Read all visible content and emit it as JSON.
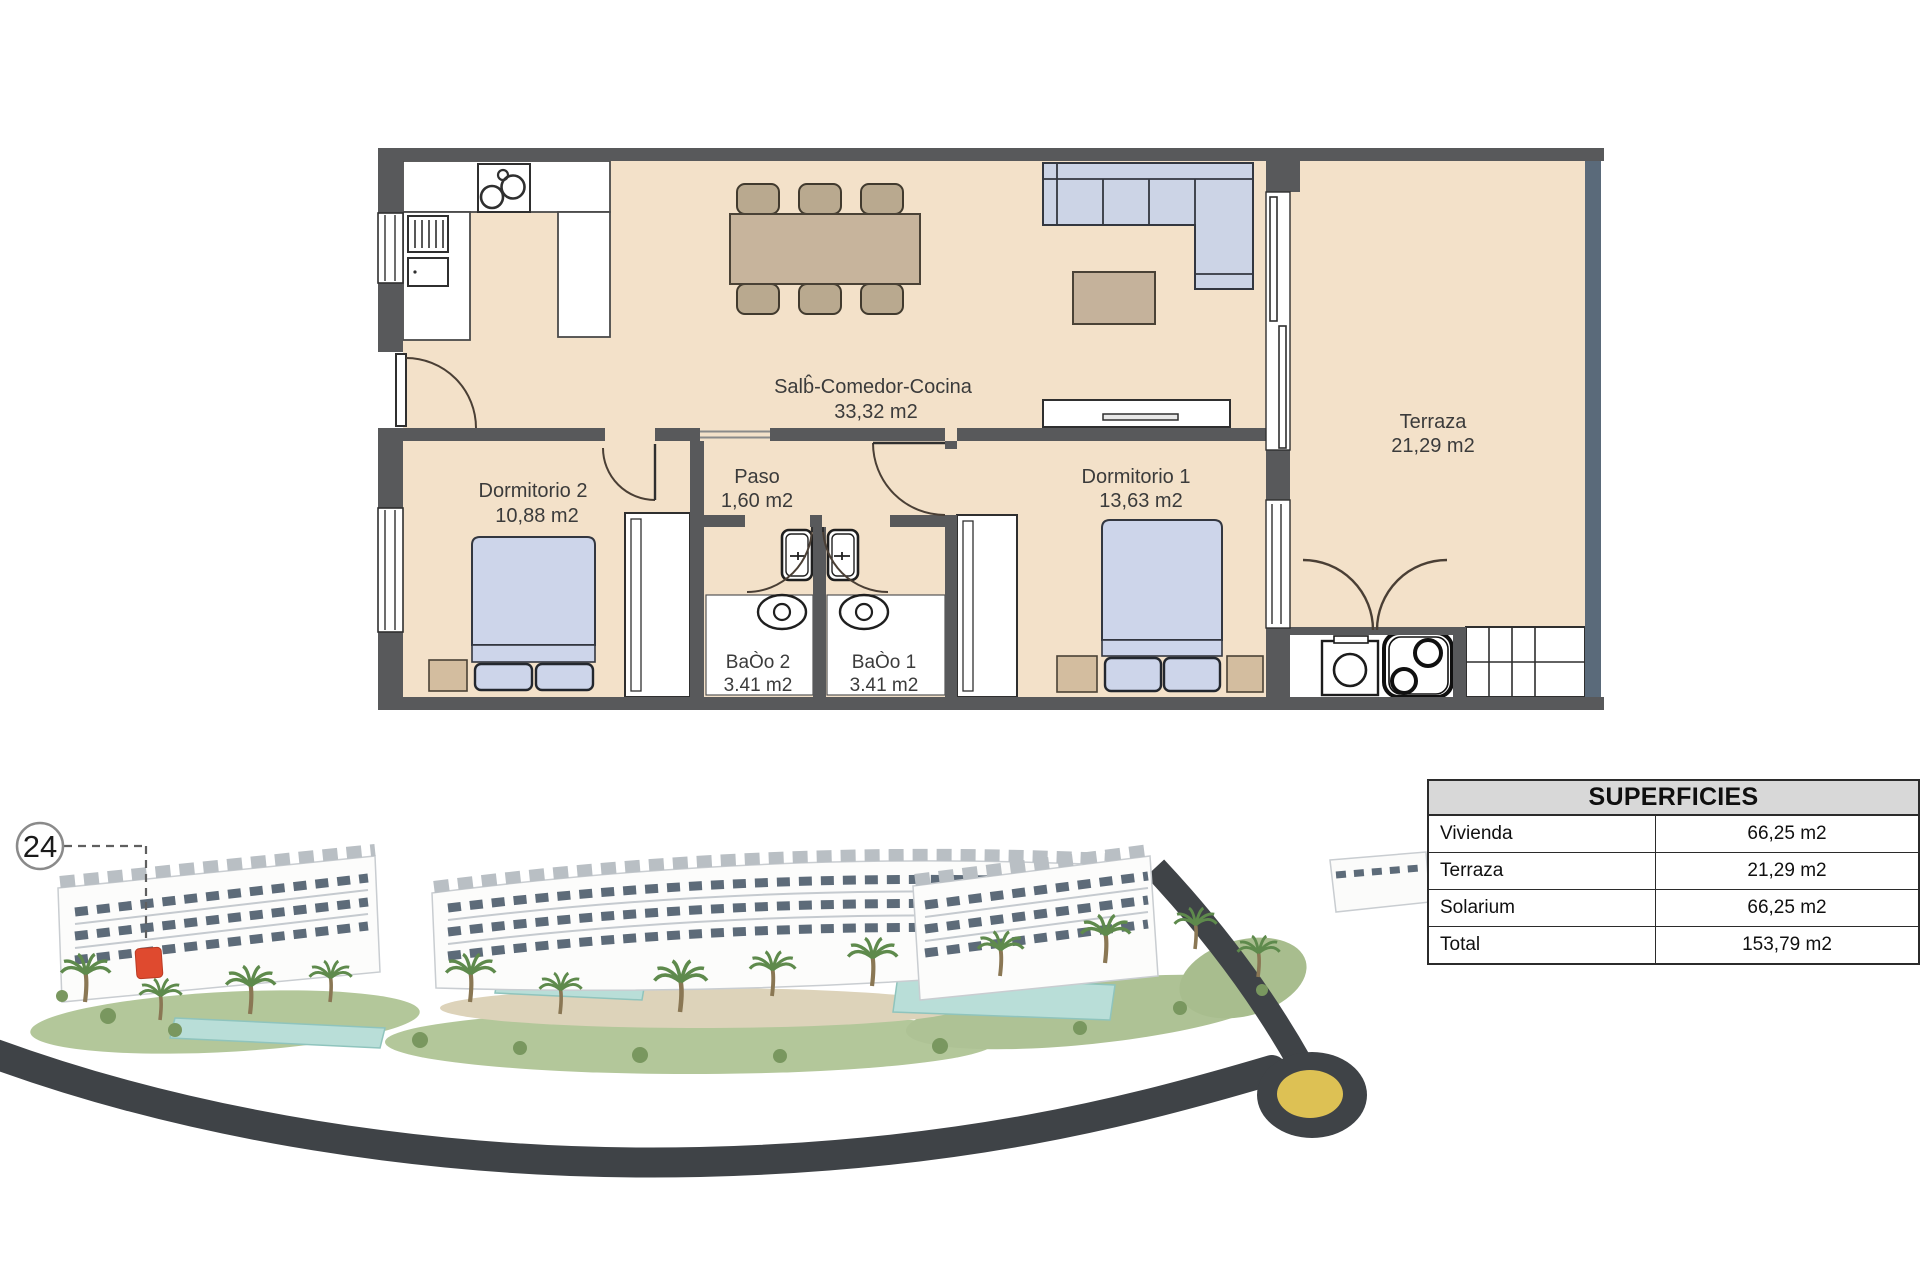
{
  "plan": {
    "rooms": {
      "salon": {
        "name": "Salb̂-Comedor-Cocina",
        "area": "33,32 m2"
      },
      "paso": {
        "name": "Paso",
        "area": "1,60 m2"
      },
      "dormitorio2": {
        "name": "Dormitorio 2",
        "area": "10,88 m2"
      },
      "dormitorio1": {
        "name": "Dormitorio 1",
        "area": "13,63 m2"
      },
      "bano2": {
        "name": "BaÒo 2",
        "area": "3.41 m2"
      },
      "bano1": {
        "name": "BaÒo 1",
        "area": "3.41 m2"
      },
      "terraza": {
        "name": "Terraza",
        "area": "21,29 m2"
      }
    }
  },
  "unit_marker": {
    "number": "24"
  },
  "superficies_table": {
    "title": "SUPERFICIES",
    "rows": [
      {
        "label": "Vivienda",
        "value": "66,25 m2"
      },
      {
        "label": "Terraza",
        "value": "21,29 m2"
      },
      {
        "label": "Solarium",
        "value": "66,25 m2"
      },
      {
        "label": "Total",
        "value": "153,79 m2"
      }
    ]
  },
  "colors": {
    "wall": "#58595b",
    "floor": "#f3e1c9",
    "furniture_blue": "#ccd4e6",
    "furniture_tan": "#c7b49c",
    "terrace_rail": "#5a6a7a",
    "table_header_bg": "#d8d8d8",
    "road": "#3f4347",
    "roundabout_yellow": "#ddc154",
    "lawn": "#b3c79a",
    "pool": "#b9ded8",
    "marker_red": "#df4a2f"
  }
}
